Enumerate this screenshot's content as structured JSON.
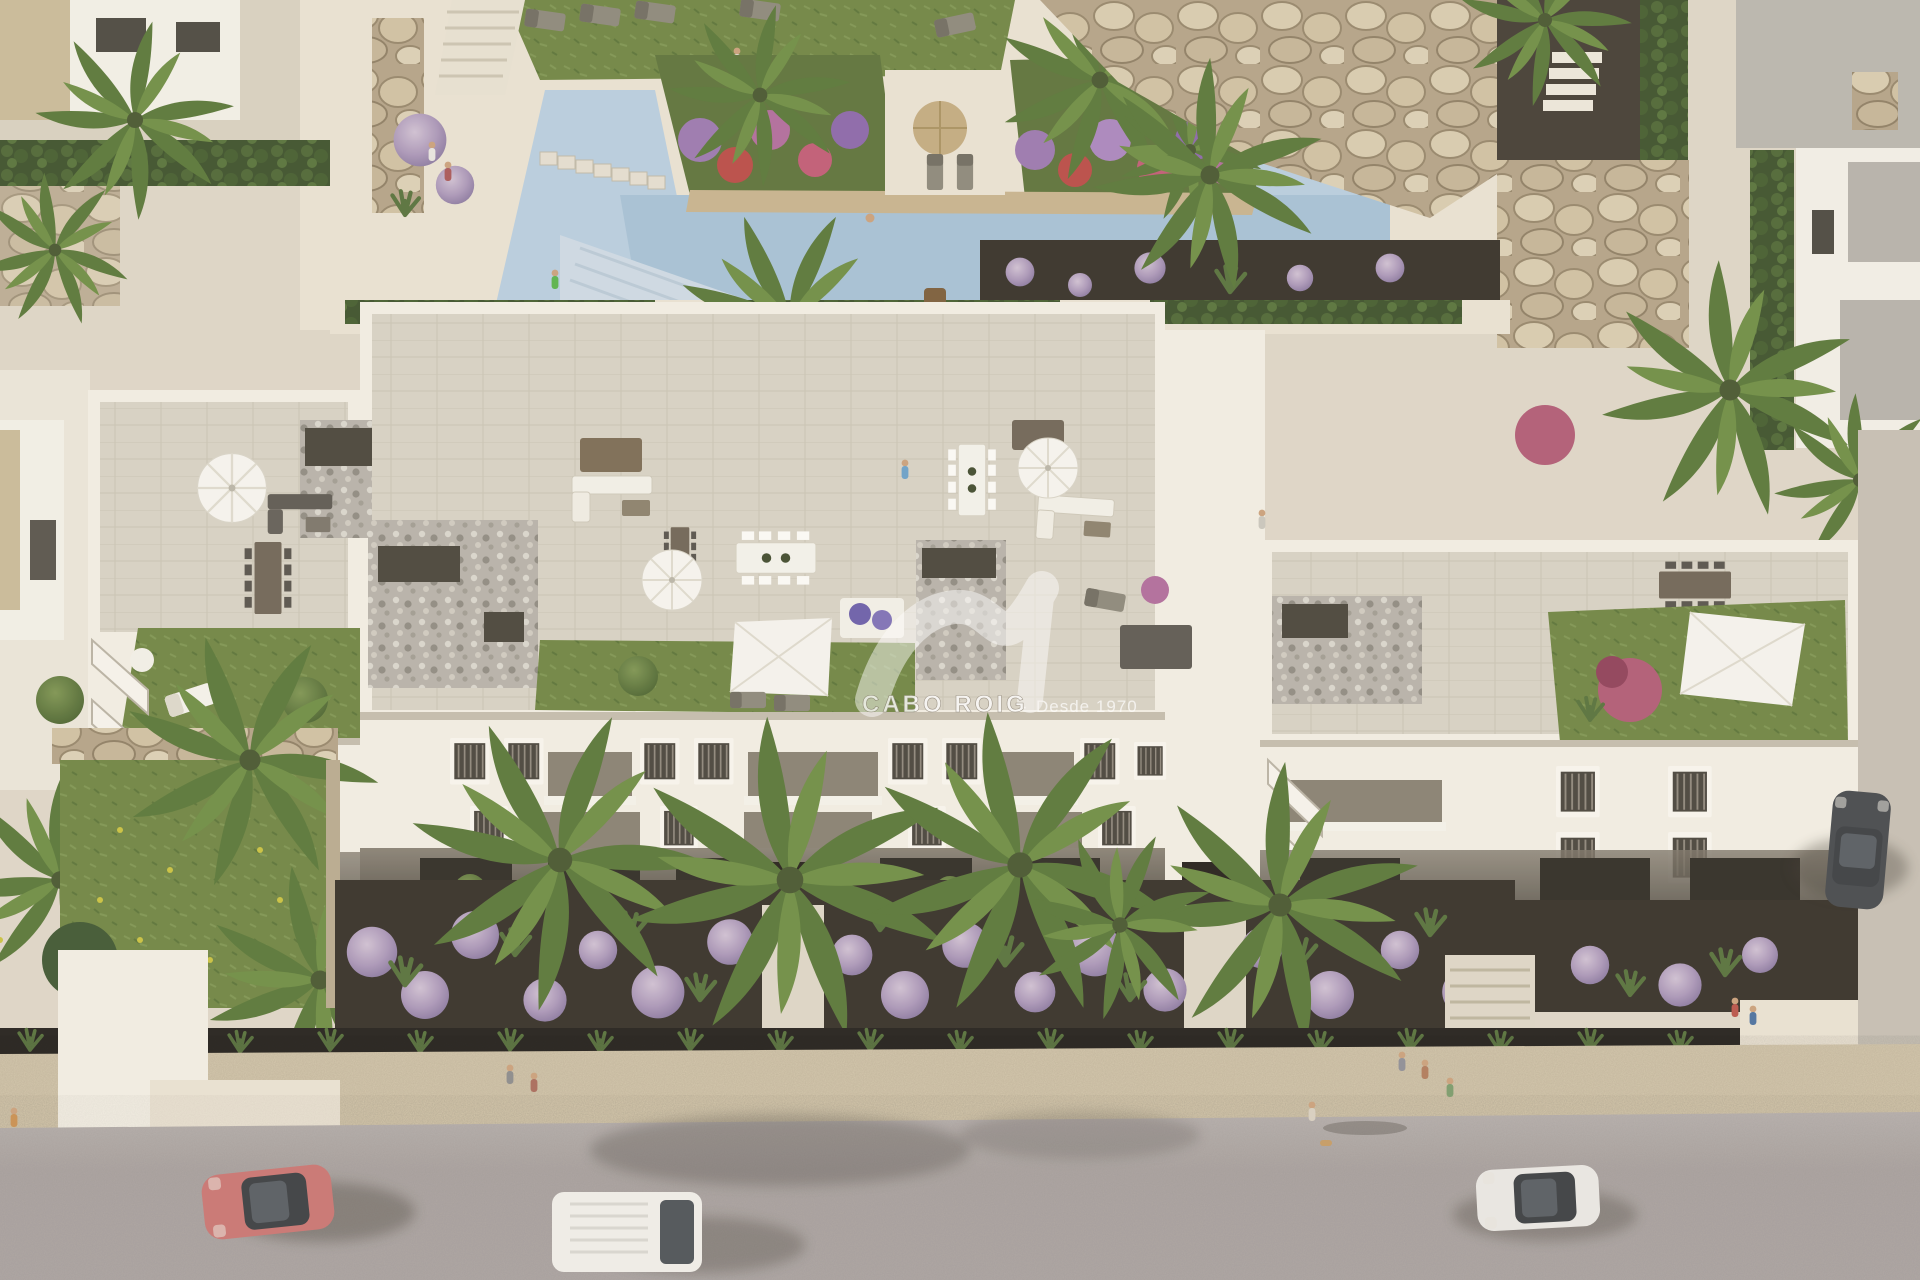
{
  "alt": "Aerial 3D render of a white Mediterranean apartment block with roof-terrace solariums, communal pool, gardens and street with vehicles",
  "watermark": {
    "brand": "CABO ROIG",
    "separator": "·",
    "tagline": "Desde 1970",
    "logo": "double-wave-swoosh"
  },
  "palette": {
    "deck": "#ddd5c5",
    "deck_bright": "#e9e1d1",
    "pool_water": "#b7cdde",
    "pool_water_deep": "#a5c0d4",
    "pool_steps": "#cdd9e3",
    "lawn": "#6e8441",
    "lawn_dark": "#5a7336",
    "lawn_front": "#647c3b",
    "building_white": "#f1ede2",
    "building_shadow": "#b7b0a1",
    "facade_recess": "#877f70",
    "terrace_tile": "#d7d1c3",
    "gravel": "#b4afa5",
    "pebble_dark": "#474339",
    "mulch": "#342f26",
    "bush_purple": "#b29fbd",
    "stone": "#cfbfa1",
    "sandstone": "#c6b28c",
    "sidewalk": "#d3c6aa",
    "road": "#a8a19e",
    "road_lit": "#b6afac",
    "palm_green": "#5f7d3c",
    "palm_dark": "#4a6530",
    "hedge": "#44582f",
    "shade_sail": "#f5f3ed",
    "umbrella_straw": "#c2aa7e",
    "car_red": "#c97470",
    "van_white": "#efede8",
    "car_dark": "#44474b",
    "car_blue": "#5b7fae",
    "car_white": "#e9e7e2",
    "flower_pink": "#c05a74",
    "flower_red": "#b84a44",
    "flower_purple": "#7d5d9e"
  },
  "scene": {
    "vehicles": [
      "red-coupe",
      "white-van",
      "white-sedan",
      "dark-parked-car",
      "blue-parked-car"
    ],
    "areas": [
      "pool-area",
      "roof-terraces",
      "apartment-facade",
      "front-garden",
      "street"
    ]
  }
}
